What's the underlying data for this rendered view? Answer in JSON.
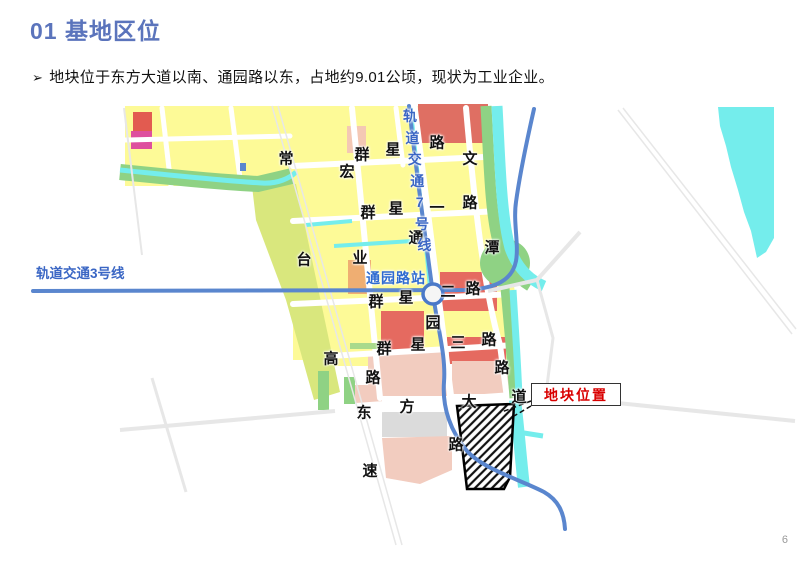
{
  "slide": {
    "title": "01 基地区位",
    "bullet": {
      "marker": "➢",
      "text": "地块位于东方大道以南、通园路以东，占地约9.01公顷，现状为工业企业。"
    },
    "page_number": "6"
  },
  "map": {
    "labels": {
      "line3": "轨道交通3号线",
      "line7": "轨道交通7号线",
      "station": "通园路站"
    },
    "callout": "地块位置",
    "roads": [
      {
        "name": "常台高速",
        "chars": [
          {
            "c": "常",
            "x": 286,
            "y": 158
          },
          {
            "c": "台",
            "x": 304,
            "y": 259
          },
          {
            "c": "高",
            "x": 331,
            "y": 358
          },
          {
            "c": "速",
            "x": 370,
            "y": 470
          }
        ]
      },
      {
        "name": "宏业路",
        "chars": [
          {
            "c": "宏",
            "x": 347,
            "y": 171
          },
          {
            "c": "业",
            "x": 360,
            "y": 257
          },
          {
            "c": "路",
            "x": 373,
            "y": 377
          }
        ]
      },
      {
        "name": "群星路",
        "chars": [
          {
            "c": "群",
            "x": 362,
            "y": 154
          },
          {
            "c": "星",
            "x": 393,
            "y": 149
          },
          {
            "c": "路",
            "x": 437,
            "y": 142
          }
        ]
      },
      {
        "name": "群星一路",
        "chars": [
          {
            "c": "群",
            "x": 368,
            "y": 212
          },
          {
            "c": "星",
            "x": 396,
            "y": 208
          },
          {
            "c": "一",
            "x": 437,
            "y": 207
          },
          {
            "c": "路",
            "x": 470,
            "y": 202
          }
        ]
      },
      {
        "name": "群星二路",
        "chars": [
          {
            "c": "群",
            "x": 376,
            "y": 301
          },
          {
            "c": "星",
            "x": 406,
            "y": 297
          },
          {
            "c": "二",
            "x": 448,
            "y": 291
          },
          {
            "c": "路",
            "x": 473,
            "y": 288
          }
        ]
      },
      {
        "name": "群星三路",
        "chars": [
          {
            "c": "群",
            "x": 384,
            "y": 348
          },
          {
            "c": "星",
            "x": 418,
            "y": 344
          },
          {
            "c": "三",
            "x": 458,
            "y": 342
          },
          {
            "c": "路",
            "x": 489,
            "y": 339
          }
        ]
      },
      {
        "name": "文潭路",
        "chars": [
          {
            "c": "文",
            "x": 470,
            "y": 158
          },
          {
            "c": "潭",
            "x": 492,
            "y": 247
          },
          {
            "c": "路",
            "x": 502,
            "y": 367
          }
        ]
      },
      {
        "name": "通园路",
        "chars": [
          {
            "c": "通",
            "x": 416,
            "y": 237
          },
          {
            "c": "园",
            "x": 433,
            "y": 322
          },
          {
            "c": "路",
            "x": 456,
            "y": 444
          }
        ]
      },
      {
        "name": "东方大道",
        "chars": [
          {
            "c": "东",
            "x": 364,
            "y": 412
          },
          {
            "c": "方",
            "x": 407,
            "y": 406
          },
          {
            "c": "大",
            "x": 469,
            "y": 401
          },
          {
            "c": "道",
            "x": 519,
            "y": 396
          }
        ]
      }
    ],
    "colors": {
      "title_blue": "#5b74bc",
      "rail_blue": "#5a86ce",
      "rail_label_blue": "#3a66c4",
      "station_label_blue": "#2f6bd0",
      "callout_red": "#d90000",
      "block_yellow": "#fdfa97",
      "block_red": "#e56a60",
      "block_magenta": "#de4f9e",
      "block_pink": "#f2ccbf",
      "block_orange": "#efae72",
      "block_gray": "#dbdbdb",
      "water_cyan": "#74edec",
      "green": "#8fd284"
    }
  }
}
